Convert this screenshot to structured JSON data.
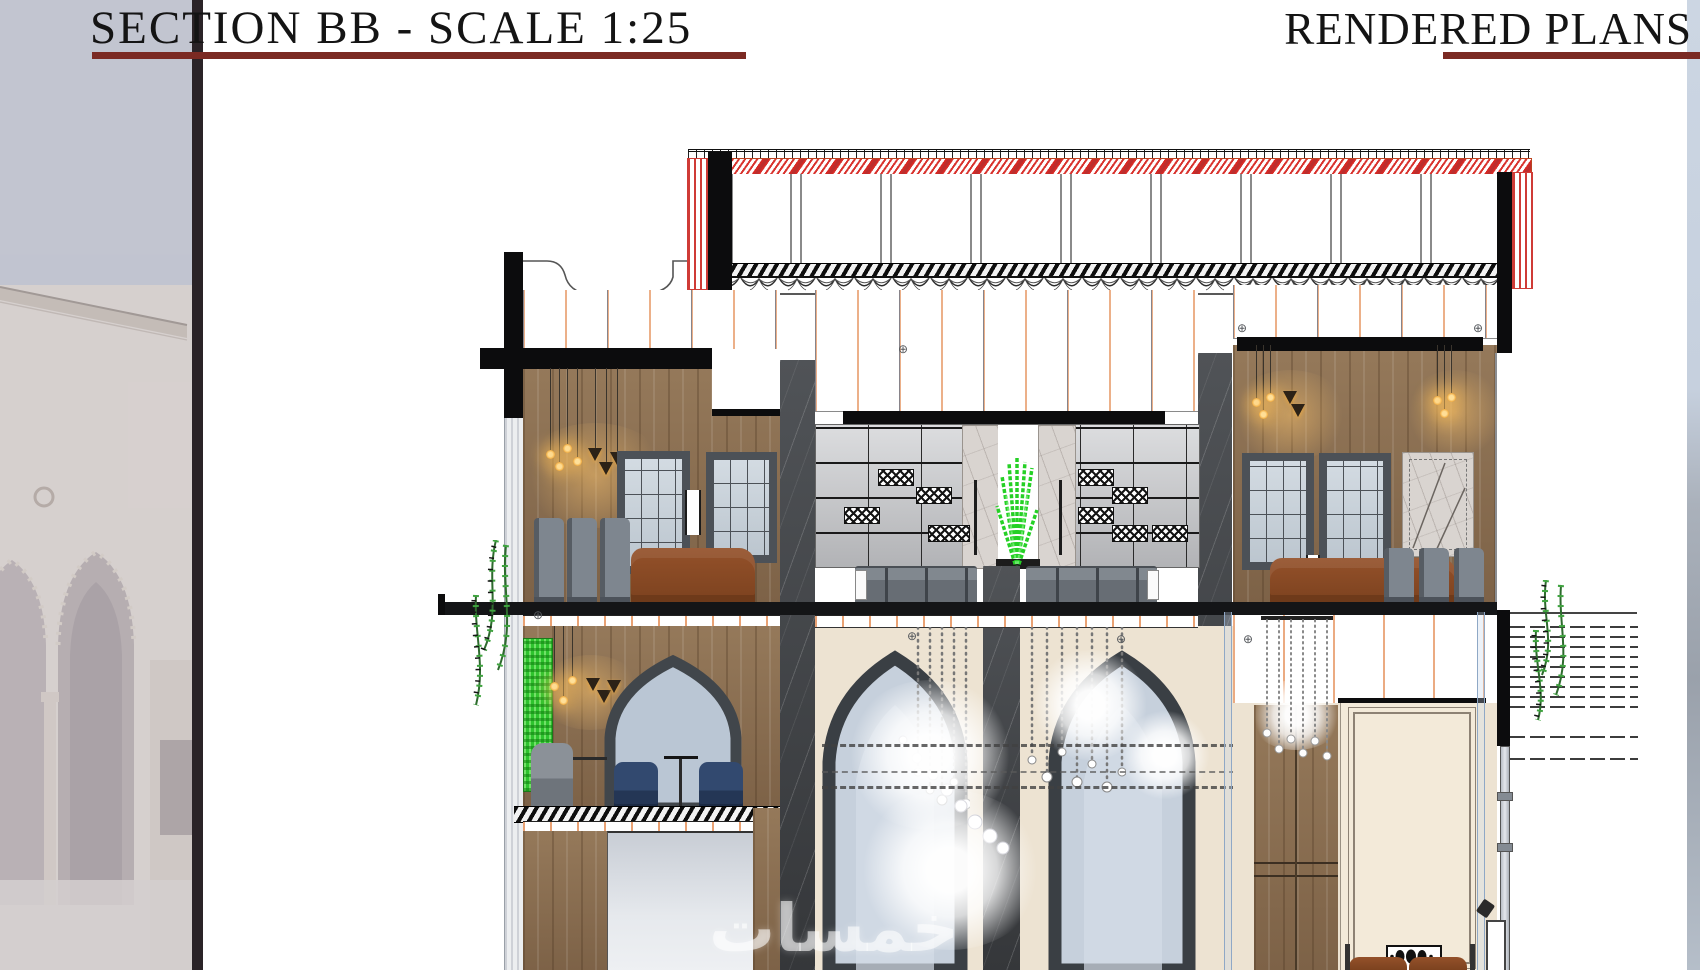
{
  "header": {
    "left_title": "SECTION BB - SCALE 1:25",
    "right_title": "RENDERED PLANS",
    "underline_color": "#7b2a23",
    "title_color": "#141414"
  },
  "watermark": {
    "text": "خمسات"
  },
  "glyphs": {
    "survey_marker": "⊕"
  },
  "colors": {
    "roof_hatch_red": "#cf3b36",
    "structure_black": "#0c0c0d",
    "wood_panel": "#8d7053",
    "marble_dark": "#434548",
    "marble_light": "#d9d4d0",
    "glass_blue": "#c6d0dc",
    "living_wall_green": "#2ec32e",
    "plant_green": "#3fa33f",
    "leather_brown": "#8a4a22",
    "armchair_navy": "#32496f",
    "chair_gray": "#7e868f",
    "booth_gray": "#6d737a",
    "wall_cream": "#ede3d2",
    "ceiling_tick_orange": "#e9a274",
    "left_photo_sky": "#b9bdca",
    "left_photo_building": "#d1cac8",
    "divider_dark": "#2a2327",
    "right_photo_sky": "#ccd6e3"
  }
}
